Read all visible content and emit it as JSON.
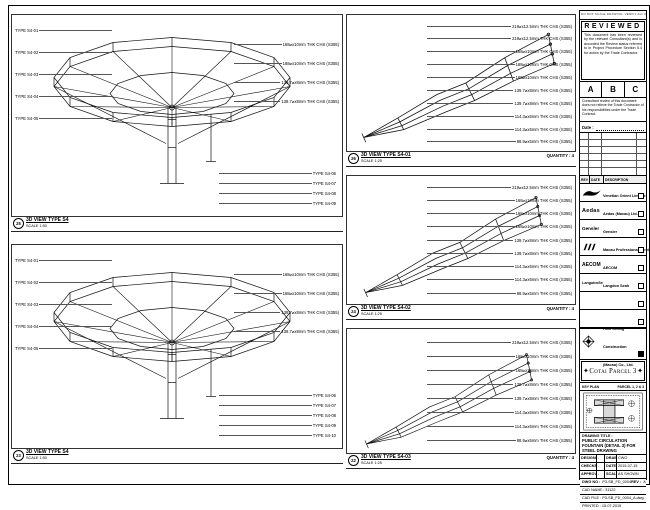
{
  "sheet_note": "DO NOT SCALE DRAWING. VERIFY ALL DIMENSIONS ON SITE.",
  "panels": {
    "left": [
      {
        "ref": "25",
        "title": "3D VIEW TYPE S4",
        "scale": "SCALE 1:50",
        "quantity": "",
        "left_labels": [
          "TYPE S4-01",
          "TYPE S4-02",
          "TYPE S4-03",
          "TYPE S4-04",
          "TYPE S4-05"
        ],
        "right_labels": [
          "168⌀x10mm THK CHS (S355)",
          "168⌀x10mm THK CHS (S355)",
          "139.7⌀x8mm THK CHS (S355)",
          "139.7⌀x8mm THK CHS (S355)"
        ],
        "bottom_labels": [
          "TYPE S4-06",
          "TYPE S4-07",
          "TYPE S4-08",
          "TYPE S4-09"
        ]
      },
      {
        "ref": "23",
        "title": "3D VIEW TYPE S4",
        "scale": "SCALE 1:50",
        "quantity": "",
        "left_labels": [
          "TYPE S4-01",
          "TYPE S4-02",
          "TYPE S4-03",
          "TYPE S4-04",
          "TYPE S4-05"
        ],
        "right_labels": [
          "168⌀x10mm THK CHS (S355)",
          "168⌀x10mm THK CHS (S355)",
          "139.7⌀x8mm THK CHS (S355)",
          "139.7⌀x8mm THK CHS (S355)"
        ],
        "bottom_labels": [
          "TYPE S4-06",
          "TYPE S4-07",
          "TYPE S4-08",
          "TYPE S4-09",
          "TYPE S4-10"
        ]
      }
    ],
    "middle": [
      {
        "ref": "26",
        "title": "3D VIEW TYPE S4-01",
        "scale": "SCALE 1:25",
        "quantity": "QUANTITY : 4",
        "annotations": [
          "219⌀x12.5mm THK CHS (S355)",
          "219⌀x12.5mm THK CHS (S355)",
          "168⌀x10mm THK CHS (S355)",
          "168⌀x10mm THK CHS (S355)",
          "168⌀x10mm THK CHS (S355)",
          "139.7⌀x8mm THK CHS (S355)",
          "139.7⌀x8mm THK CHS (S355)",
          "114.3⌀x6mm THK CHS (S355)",
          "114.3⌀x6mm THK CHS (S355)",
          "88.9⌀x5mm THK CHS (S355)"
        ]
      },
      {
        "ref": "24",
        "title": "3D VIEW TYPE S4-02",
        "scale": "SCALE 1:25",
        "quantity": "QUANTITY : 4",
        "annotations": [
          "219⌀x12.5mm THK CHS (S355)",
          "168⌀x10mm THK CHS (S355)",
          "168⌀x10mm THK CHS (S355)",
          "168⌀x10mm THK CHS (S355)",
          "139.7⌀x8mm THK CHS (S355)",
          "139.7⌀x8mm THK CHS (S355)",
          "114.3⌀x6mm THK CHS (S355)",
          "114.3⌀x6mm THK CHS (S355)",
          "88.9⌀x5mm THK CHS (S355)"
        ]
      },
      {
        "ref": "22",
        "title": "3D VIEW TYPE S4-03",
        "scale": "SCALE 1:25",
        "quantity": "QUANTITY : 4",
        "annotations": [
          "219⌀x12.5mm THK CHS (S355)",
          "168⌀x10mm THK CHS (S355)",
          "168⌀x10mm THK CHS (S355)",
          "139.7⌀x8mm THK CHS (S355)",
          "139.7⌀x8mm THK CHS (S355)",
          "114.3⌀x6mm THK CHS (S355)",
          "114.3⌀x6mm THK CHS (S355)",
          "88.9⌀x5mm THK CHS (S355)"
        ]
      }
    ]
  },
  "stamp": {
    "title": "REVIEWED",
    "body": "This document has been reviewed by the relevant Consultant(s) and is accorded the Review status referred to in Project Procedure Section 5.4 for action by the Trade Contractor.",
    "grades": [
      "A",
      "B",
      "C"
    ],
    "note": "Consultant review of this document does not relieve the Trade Contractor of his responsibilities under the Trade Contract.",
    "date_label": "Date :"
  },
  "rev_header": {
    "rev": "REV",
    "date": "DATE",
    "description": "DESCRIPTION"
  },
  "consultants": [
    {
      "name": "Venetian Orient Limited"
    },
    {
      "logo": "Aedas",
      "name": "Aedas (Macau) Ltd."
    },
    {
      "logo": "Gensler",
      "name": "Gensler"
    },
    {
      "name": "Macau Professional Services Ltd."
    },
    {
      "logo": "AECOM",
      "name": "AECOM"
    },
    {
      "logo": "LangdonSeah",
      "name": "Langdon Seah"
    }
  ],
  "contractor": {
    "name": "Hsin Chong Construction (Macau) Co., Ltd."
  },
  "banner": {
    "text": "Cotai Parcel 3",
    "ornament": "✦"
  },
  "keyplan": {
    "left": "KEY PLAN",
    "right": "PARCEL 1, 2 & 3"
  },
  "titleblock": {
    "label": "DRAWING TITLE :",
    "title": "PUBLIC CIRCULATION FOUNTAIN (DETAIL 3) FOR STEEL DRAWING",
    "rows": [
      [
        "DESIGNED",
        "-",
        "DRAWN",
        "CWO"
      ],
      [
        "CHECKED",
        "-",
        "DATE",
        "2015-07-15"
      ],
      [
        "APPROVED",
        "-",
        "SCALE",
        "AS SHOWN"
      ]
    ],
    "dwg_label": "DWG NO :",
    "dwg_no": "P3-SB_FD_0004",
    "rev_label": "REV :",
    "rev": "A",
    "cad_name": "CAD NAME : 31122",
    "cad_file": "CAD FILE : P3-SB_FD_0004_A.dwg",
    "printed": "PRINTED : 15-07-2015"
  }
}
